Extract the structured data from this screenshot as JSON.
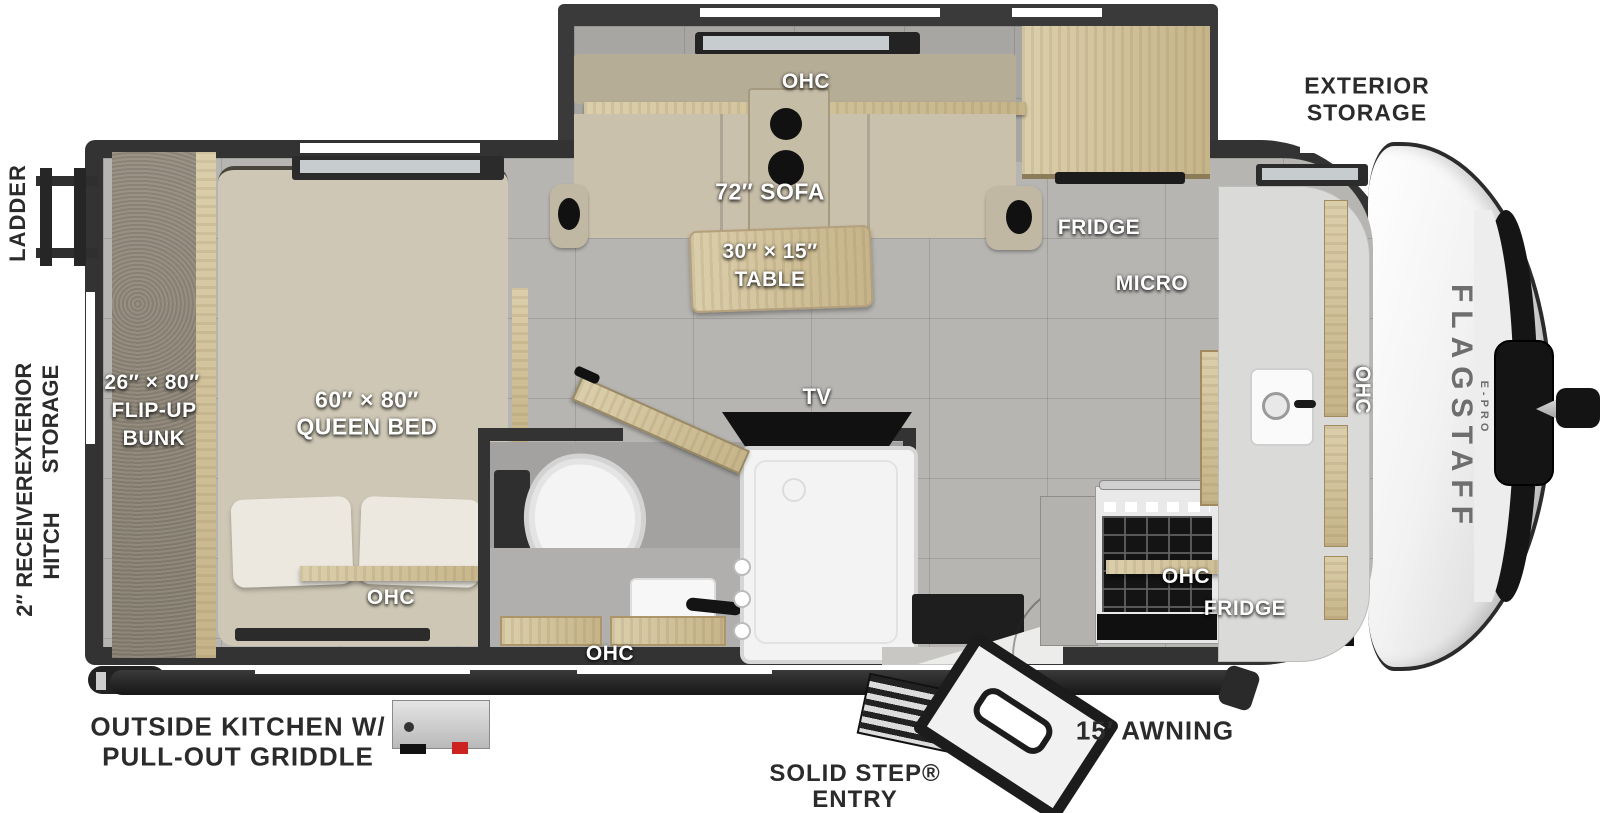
{
  "page": {
    "title": "Flagstaff E-Pro Travel Trailer Floorplan"
  },
  "colors": {
    "wall": "#333333",
    "floor": "#b6b5b2",
    "wood": "#d3c5a4",
    "upholstery": "#cac1ad",
    "label_light": "#ffffff",
    "label_dark": "#2b2b2b",
    "griddle_accent": "#cc2222"
  },
  "branding": {
    "model": "FLAGSTAFF",
    "series": "E-PRO"
  },
  "interior": {
    "ohc": "OHC",
    "sofa": "72″ SOFA",
    "table_size": "30″ × 15″",
    "table_word": "TABLE",
    "fridge": "FRIDGE",
    "micro": "MICRO",
    "tv": "TV",
    "bunk_size": "26″ × 80″",
    "bunk_word1": "FLIP-UP",
    "bunk_word2": "BUNK",
    "bed_size": "60″ × 80″",
    "bed_word": "QUEEN BED"
  },
  "exterior": {
    "front_storage_line1": "EXTERIOR",
    "front_storage_line2": "STORAGE",
    "ladder": "LADDER",
    "rear_storage_line1": "EXTERIOR",
    "rear_storage_line2": "STORAGE",
    "hitch_line1": "2″ RECEIVER",
    "hitch_line2": "HITCH",
    "outside_kitchen_line1": "OUTSIDE KITCHEN W/",
    "outside_kitchen_line2": "PULL-OUT GRIDDLE",
    "entry_line1": "SOLID STEP®",
    "entry_line2": "ENTRY",
    "awning": "15′ AWNING"
  }
}
